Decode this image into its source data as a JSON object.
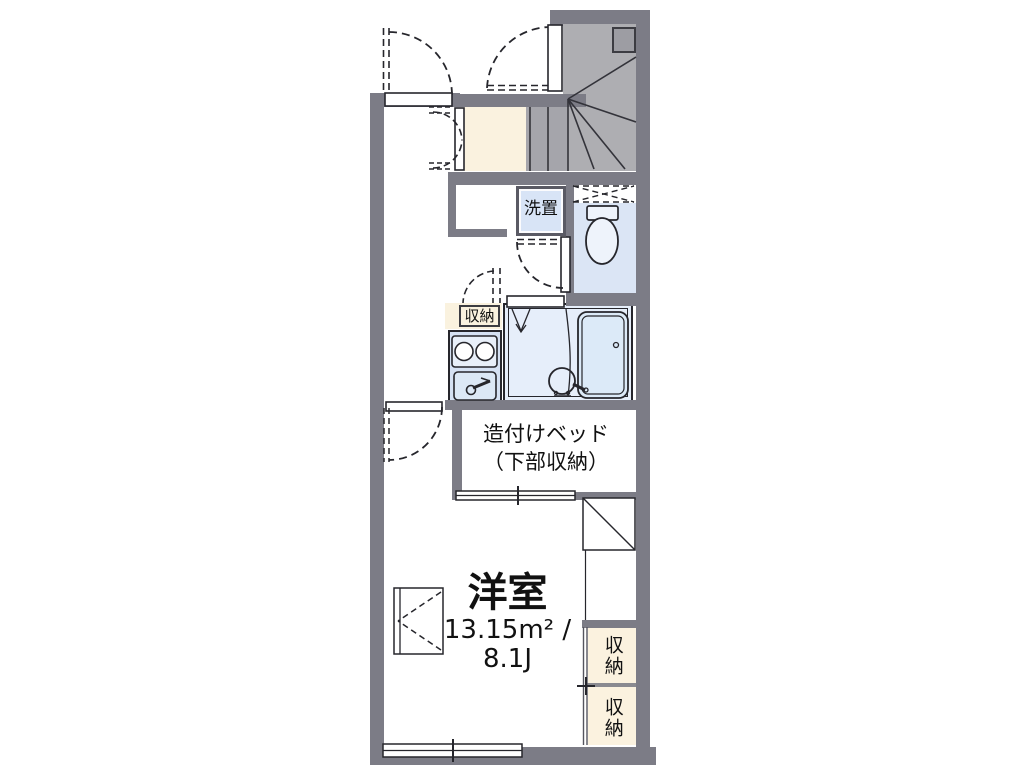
{
  "plan": {
    "main_room": {
      "name": "洋室",
      "area_line": "13.15m² /",
      "jo_line": "8.1J"
    },
    "bed": {
      "line1": "造付けベッド",
      "line2": "（下部収納）"
    },
    "washer_label": "洗置",
    "kitchen_storage_label": "収納",
    "closet_upper_label": "収納",
    "closet_lower_label": "収納"
  },
  "colors": {
    "wall_gray": "#7c7c86",
    "stair_gray": "#aeaeb2",
    "floor_cream": "#faf2df",
    "wet_area_blue": "#dbe5f5",
    "fixture_blue": "#d5e1f3",
    "bath_blue": "#e6eefa",
    "outline": "#26262c"
  }
}
